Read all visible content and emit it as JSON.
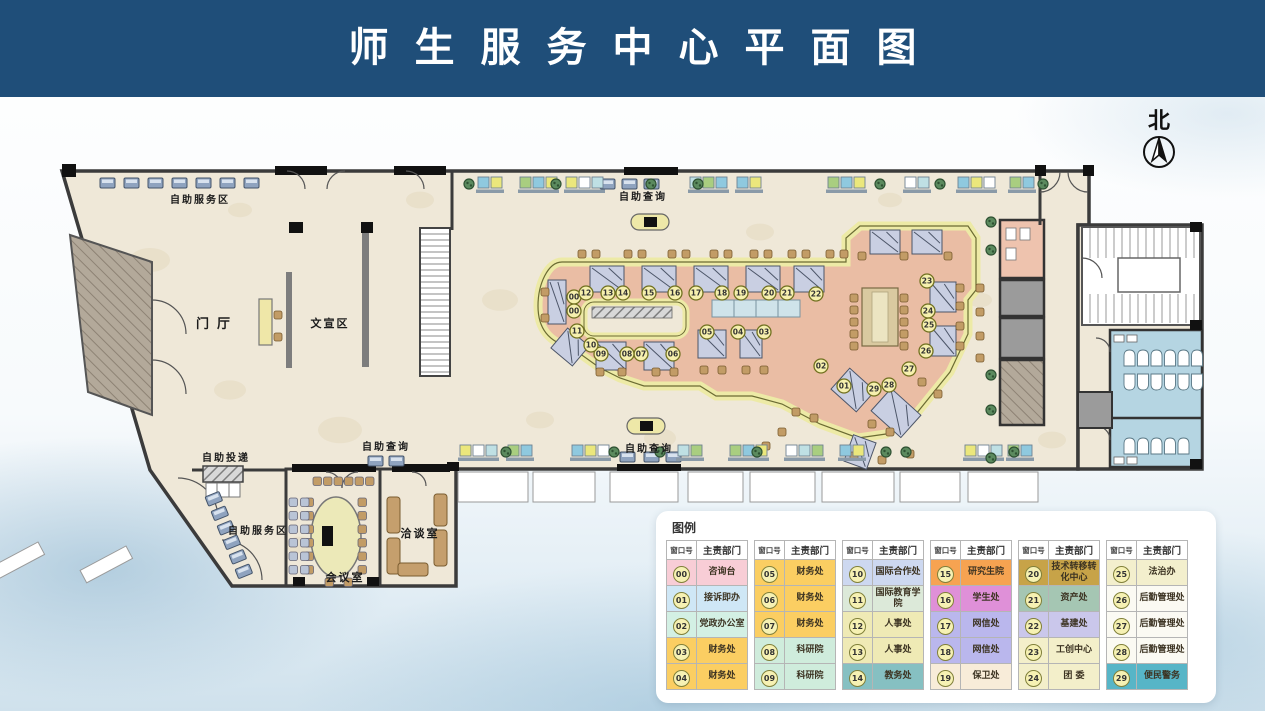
{
  "header": {
    "title": "师生服务中心平面图"
  },
  "north": {
    "label": "北"
  },
  "plan": {
    "area_labels": [
      {
        "id": "self-service-top",
        "label": "自助服务区",
        "x": 200,
        "y": 203,
        "size": 10
      },
      {
        "id": "entrance-hall",
        "label": "门厅",
        "x": 217,
        "y": 328,
        "size": 13,
        "spacing": 8
      },
      {
        "id": "publicity-area",
        "label": "文宣区",
        "x": 330,
        "y": 327,
        "size": 11
      },
      {
        "id": "self-delivery",
        "label": "自助投递",
        "x": 226,
        "y": 461,
        "size": 10
      },
      {
        "id": "self-inquiry-left",
        "label": "自助查询",
        "x": 386,
        "y": 450,
        "size": 10
      },
      {
        "id": "self-service-bottom",
        "label": "自助服务区",
        "x": 258,
        "y": 534,
        "size": 10
      },
      {
        "id": "negotiation-room",
        "label": "洽谈室",
        "x": 420,
        "y": 537,
        "size": 11
      },
      {
        "id": "meeting-room",
        "label": "会议室",
        "x": 345,
        "y": 581,
        "size": 11
      },
      {
        "id": "self-inquiry-top",
        "label": "自助查询",
        "x": 643,
        "y": 200,
        "size": 10
      },
      {
        "id": "self-inquiry-bottom",
        "label": "自助查询",
        "x": 649,
        "y": 452,
        "size": 10
      }
    ],
    "windows": [
      {
        "num": "00",
        "x": 574,
        "y": 297
      },
      {
        "num": "00",
        "x": 574,
        "y": 311
      },
      {
        "num": "01",
        "x": 844,
        "y": 386
      },
      {
        "num": "02",
        "x": 821,
        "y": 366
      },
      {
        "num": "03",
        "x": 764,
        "y": 332
      },
      {
        "num": "04",
        "x": 738,
        "y": 332
      },
      {
        "num": "05",
        "x": 707,
        "y": 332
      },
      {
        "num": "06",
        "x": 673,
        "y": 354
      },
      {
        "num": "07",
        "x": 641,
        "y": 354
      },
      {
        "num": "08",
        "x": 627,
        "y": 354
      },
      {
        "num": "09",
        "x": 601,
        "y": 354
      },
      {
        "num": "10",
        "x": 591,
        "y": 345
      },
      {
        "num": "11",
        "x": 577,
        "y": 331
      },
      {
        "num": "12",
        "x": 586,
        "y": 293
      },
      {
        "num": "13",
        "x": 608,
        "y": 293
      },
      {
        "num": "14",
        "x": 623,
        "y": 293
      },
      {
        "num": "15",
        "x": 649,
        "y": 293
      },
      {
        "num": "16",
        "x": 675,
        "y": 293
      },
      {
        "num": "17",
        "x": 696,
        "y": 293
      },
      {
        "num": "18",
        "x": 722,
        "y": 293
      },
      {
        "num": "19",
        "x": 741,
        "y": 293
      },
      {
        "num": "20",
        "x": 769,
        "y": 293
      },
      {
        "num": "21",
        "x": 787,
        "y": 293
      },
      {
        "num": "22",
        "x": 816,
        "y": 294
      },
      {
        "num": "23",
        "x": 927,
        "y": 281
      },
      {
        "num": "24",
        "x": 928,
        "y": 311
      },
      {
        "num": "25",
        "x": 929,
        "y": 325
      },
      {
        "num": "26",
        "x": 926,
        "y": 351
      },
      {
        "num": "27",
        "x": 909,
        "y": 369
      },
      {
        "num": "28",
        "x": 889,
        "y": 385
      },
      {
        "num": "29",
        "x": 874,
        "y": 389
      }
    ]
  },
  "legend": {
    "title": "图例",
    "col_headers": [
      "窗口号",
      "主责部门"
    ],
    "groups": [
      [
        {
          "num": "00",
          "dept": "咨询台",
          "color": "#f8cdd6"
        },
        {
          "num": "01",
          "dept": "接诉即办",
          "color": "#cfe7f6"
        },
        {
          "num": "02",
          "dept": "党政办公室",
          "color": "#d3f0e4"
        },
        {
          "num": "03",
          "dept": "财务处",
          "color": "#fbce62"
        },
        {
          "num": "04",
          "dept": "财务处",
          "color": "#fbce62"
        }
      ],
      [
        {
          "num": "05",
          "dept": "财务处",
          "color": "#fbce62"
        },
        {
          "num": "06",
          "dept": "财务处",
          "color": "#fbce62"
        },
        {
          "num": "07",
          "dept": "财务处",
          "color": "#fbce62"
        },
        {
          "num": "08",
          "dept": "科研院",
          "color": "#cfecdc"
        },
        {
          "num": "09",
          "dept": "科研院",
          "color": "#cfecdc"
        }
      ],
      [
        {
          "num": "10",
          "dept": "国际合作处",
          "color": "#cdd8f0"
        },
        {
          "num": "11",
          "dept": "国际教育学院",
          "color": "#dce9d9"
        },
        {
          "num": "12",
          "dept": "人事处",
          "color": "#efeab5"
        },
        {
          "num": "13",
          "dept": "人事处",
          "color": "#efeab5"
        },
        {
          "num": "14",
          "dept": "教务处",
          "color": "#86c0c2"
        }
      ],
      [
        {
          "num": "15",
          "dept": "研究生院",
          "color": "#f6a351"
        },
        {
          "num": "16",
          "dept": "学生处",
          "color": "#df90d8"
        },
        {
          "num": "17",
          "dept": "网信处",
          "color": "#bab7ed"
        },
        {
          "num": "18",
          "dept": "网信处",
          "color": "#bab7ed"
        },
        {
          "num": "19",
          "dept": "保卫处",
          "color": "#f8ecd9"
        }
      ],
      [
        {
          "num": "20",
          "dept": "技术转移转化中心",
          "color": "#c7a348"
        },
        {
          "num": "21",
          "dept": "资产处",
          "color": "#a5c6b3"
        },
        {
          "num": "22",
          "dept": "基建处",
          "color": "#cac7eb"
        },
        {
          "num": "23",
          "dept": "工创中心",
          "color": "#f3efca"
        },
        {
          "num": "24",
          "dept": "团 委",
          "color": "#f3efca"
        }
      ],
      [
        {
          "num": "25",
          "dept": "法治办",
          "color": "#f3efcd"
        },
        {
          "num": "26",
          "dept": "后勤管理处",
          "color": "#fbfaf3"
        },
        {
          "num": "27",
          "dept": "后勤管理处",
          "color": "#fbfaf3"
        },
        {
          "num": "28",
          "dept": "后勤管理处",
          "color": "#fbfaf3"
        },
        {
          "num": "29",
          "dept": "便民警务",
          "color": "#57b5c7"
        }
      ]
    ]
  }
}
